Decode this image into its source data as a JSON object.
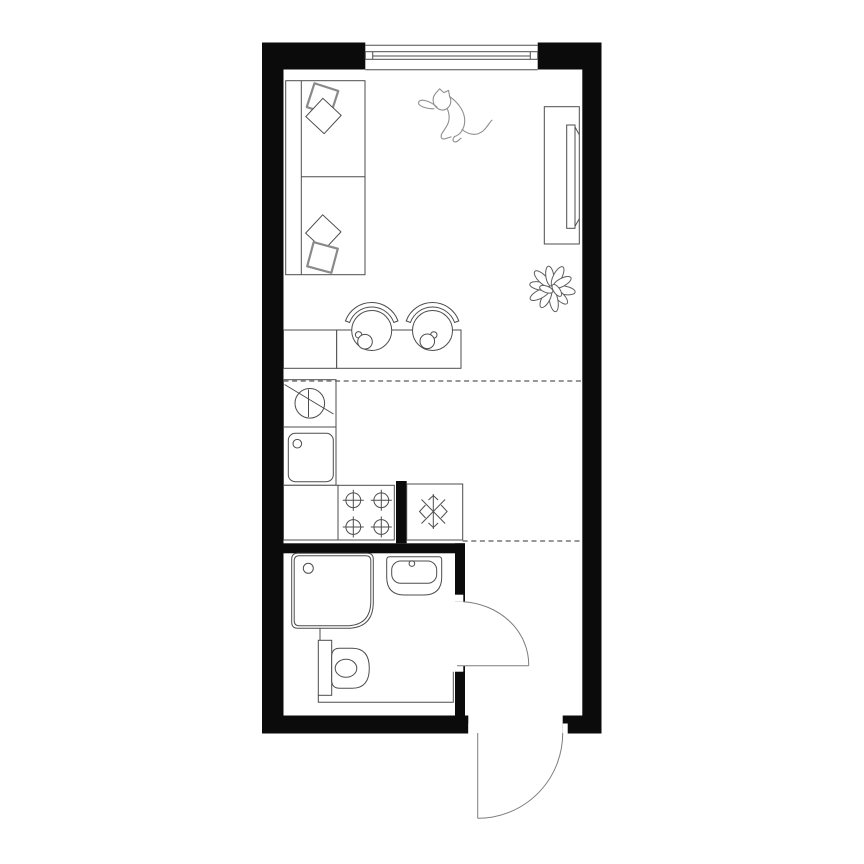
{
  "canvas": {
    "width": 864,
    "height": 864,
    "background": "#ffffff"
  },
  "palette": {
    "wall_fill": "#0b0b0b",
    "line": "#4d4d4d",
    "line_soft": "#8a8a8a",
    "door_arc": "#7d7d7d",
    "separator": "#5a5a5a",
    "floor": "#ffffff"
  },
  "plan": {
    "kind": "studio-apartment-floor-plan",
    "style": "top-down black-and-white line drawing, no text labels",
    "zones": [
      {
        "name": "living-area",
        "fixtures": [
          "window",
          "sofa",
          "pillow",
          "pillow",
          "pillow",
          "pillow",
          "wardrobe",
          "cat-sketch",
          "potted-plant"
        ]
      },
      {
        "name": "kitchen",
        "fixtures": [
          "base-cabinet",
          "bar-counter",
          "bar-stool",
          "bar-stool",
          "cup",
          "cup",
          "washing-machine",
          "kitchen-sink",
          "corner-cabinet",
          "stove-four-burners",
          "refrigerator"
        ]
      },
      {
        "name": "bathroom",
        "fixtures": [
          "shower-tray",
          "washbasin",
          "toilet",
          "service-duct-ledge"
        ]
      },
      {
        "name": "entry-hall",
        "fixtures": []
      }
    ],
    "openings": {
      "window_count": 1,
      "doors": [
        {
          "name": "bathroom-door",
          "swing": "quarter-circle-into-hall"
        },
        {
          "name": "entry-door",
          "swing": "quarter-circle-outward"
        }
      ]
    },
    "separators": {
      "dashed_zone_lines": 2
    },
    "symbols": [
      "washer-circle-diagonal",
      "snowflake-freezer",
      "burner-cross",
      "door-swing-arc"
    ]
  }
}
